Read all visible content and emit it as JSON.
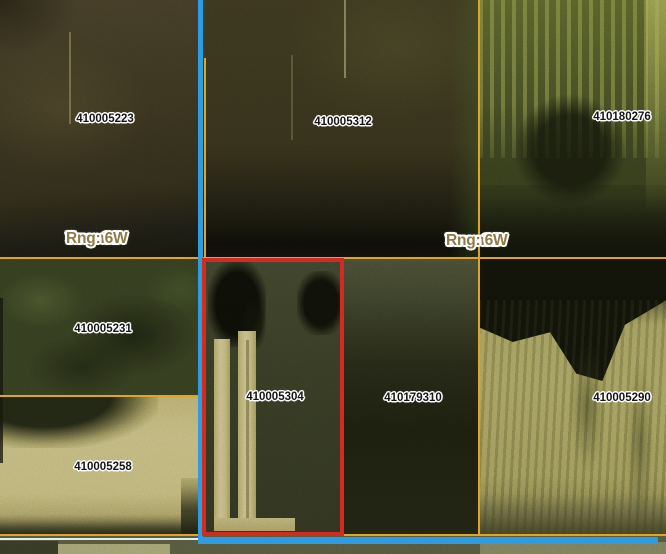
{
  "parcels": [
    {
      "id": "410005223"
    },
    {
      "id": "410005312"
    },
    {
      "id": "410180276"
    },
    {
      "id": "410005231"
    },
    {
      "id": "410005304",
      "highlighted": true
    },
    {
      "id": "410179310"
    },
    {
      "id": "410005290"
    },
    {
      "id": "410005258"
    }
  ],
  "sections": [
    {
      "sec": "Sec: 31",
      "town": "Town: 9",
      "rng": "Rng: 6W"
    },
    {
      "sec": "Sec: 32",
      "town": "Town: 9",
      "rng": "Rng: 6W"
    }
  ],
  "highlighted_parcel_id": "410005304",
  "colors": {
    "selection_red": "#d22b22",
    "boundary_blue": "#2d9ce2",
    "parcel_line_orange": "#dfa428",
    "section_label_tan": "#8e7b49",
    "parcel_label_black": "#151515"
  }
}
